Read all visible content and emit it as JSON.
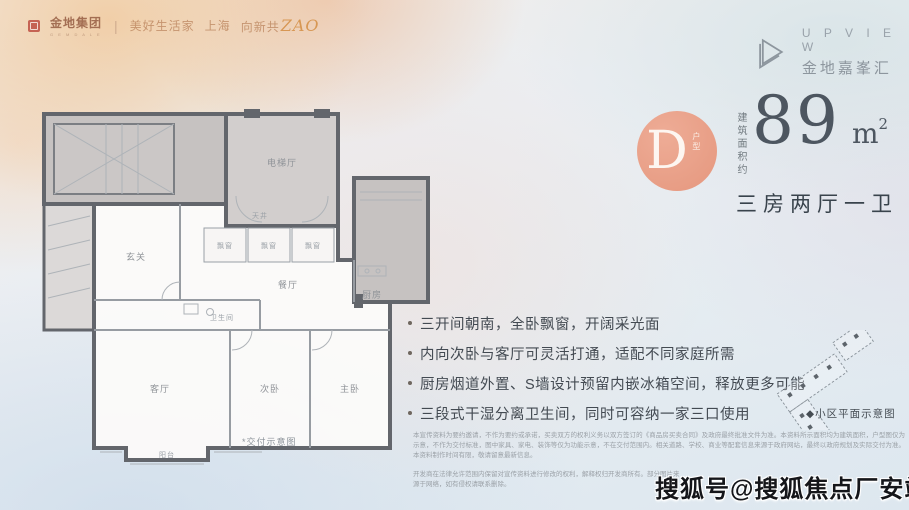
{
  "header": {
    "group": {
      "logo_icon": "gemdale-seal-icon",
      "name": "金地集团",
      "name_sub": "G E M D A L E",
      "divider": "|",
      "slogan": "美好生活家",
      "city": "上海",
      "campaign_prefix": "向新共",
      "campaign_stylized": "ZAO"
    },
    "brand": {
      "icon": "upview-triangle-icon",
      "name_en": "U P V I E W",
      "name_cn": "金地嘉峯汇"
    }
  },
  "unit": {
    "type_letter": "D",
    "type_suffix": "户型",
    "area_label_vertical": "建筑面积约",
    "area_value": "89",
    "area_unit": "m",
    "area_unit_sup": "2",
    "layout": "三房两厅一卫"
  },
  "features": [
    {
      "text": "三开间朝南，全卧飘窗，开阔采光面"
    },
    {
      "text": "内向次卧与客厅可灵活打通，适配不同家庭所需"
    },
    {
      "text": "厨房烟道外置、S墙设计预留内嵌冰箱空间，释放更多可能"
    },
    {
      "text": "三段式干湿分离卫生间，同时可容纳一家三口使用"
    }
  ],
  "floorplan": {
    "caption": "*交付示意图",
    "rooms": [
      {
        "label": "电梯厅"
      },
      {
        "label": "天井"
      },
      {
        "label": "玄关"
      },
      {
        "label": "餐厅"
      },
      {
        "label": "厨房"
      },
      {
        "label": "客厅"
      },
      {
        "label": "次卧"
      },
      {
        "label": "主卧"
      },
      {
        "label": "卫生间"
      },
      {
        "label": "阳台"
      },
      {
        "label": "飘窗"
      },
      {
        "label": "飘窗"
      },
      {
        "label": "飘窗"
      }
    ]
  },
  "siteplan": {
    "caption": "◆小区平面示意图"
  },
  "disclaimer": {
    "line1": "本宣传资料为要约邀请，不作为要约或承诺，买卖双方的权利义务以双方签订的《商品房买卖合同》及政府最终批准文件为准。本资料所示面积均为建筑面积，户型图仅为示意，不作为交付标准，图中家具、家电、装饰等仅为功能示意，不在交付范围内。相关道路、学校、商业等配套信息来源于政府网站，最终以政府规划及实际交付为准。本资料制作时间有限，敬请留意最新信息。",
    "line2": "开发商在法律允许范围内保留对宣传资料进行修改的权利，解释权归开发商所有。部分图片来源于网络，如有侵权请联系删除。"
  },
  "watermark": "搜狐号@搜狐焦点厂安站",
  "colors": {
    "accent": "#E5977E",
    "ink": "#4D5660",
    "wall": "#63666C"
  }
}
